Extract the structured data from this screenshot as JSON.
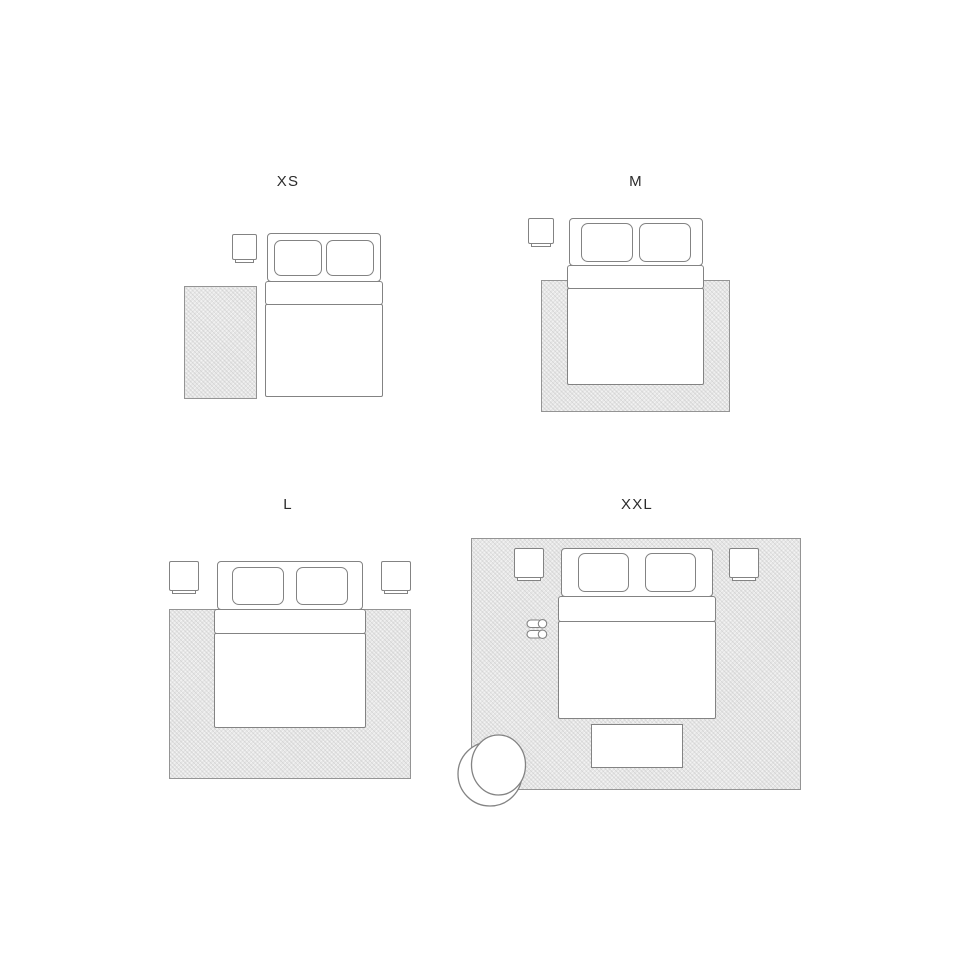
{
  "scenes": [
    {
      "id": "xs",
      "label": "XS"
    },
    {
      "id": "m",
      "label": "M"
    },
    {
      "id": "l",
      "label": "L"
    },
    {
      "id": "xxl",
      "label": "XXL"
    }
  ],
  "colors": {
    "background": "#ffffff",
    "outline": "#838383",
    "rug_fill": "#e6e6e6",
    "rug_border": "#949494",
    "label_text": "#2c2c2c",
    "furniture_fill": "#ffffff"
  },
  "icons": {
    "rug": "rug-icon",
    "bed": "bed-icon",
    "pillow": "pillow-icon",
    "nightstand": "nightstand-icon",
    "bench": "bench-icon",
    "armchair": "armchair-icon",
    "slippers": "slippers-icon"
  }
}
